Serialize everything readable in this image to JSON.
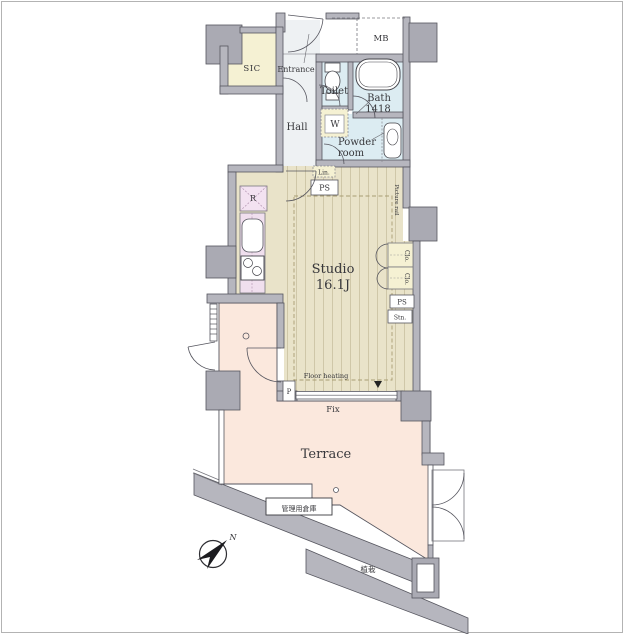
{
  "rooms": {
    "studio": {
      "label": "Studio",
      "size": "16.1J"
    },
    "terrace": {
      "label": "Terrace"
    },
    "hall": {
      "label": "Hall"
    },
    "entrance": {
      "label": "Entrance"
    },
    "toilet": {
      "label": "Toilet"
    },
    "bath": {
      "label": "Bath",
      "size": "1418"
    },
    "powder_room": {
      "line1": "Powder",
      "line2": "room"
    },
    "sic": {
      "label": "SIC"
    },
    "mb": {
      "label": "MB"
    }
  },
  "fixtures": {
    "linen": "Lin.",
    "ps_top": "PS",
    "fridge": "R",
    "washer": "W",
    "closet_upper": "Clo.",
    "closet_lower": "Clo.",
    "ps_right": "PS",
    "station": "Stn.",
    "picture_rail": "Picture rail",
    "floor_heating": "Floor heating",
    "fix_window": "Fix",
    "pipe_p": "P",
    "storage": "管理用倉庫",
    "planting": "植栽",
    "north": "N"
  },
  "colors": {
    "wall": "#b6b6be",
    "pillar": "#aaaab3",
    "wet_area": "#dcecf2",
    "pale_yellow": "#f5f1d3",
    "hall_floor": "#eef1f3",
    "wood_floor": "#e9e3c9",
    "wood_line": "#cfc7a8",
    "kitchen": "#f0dfee",
    "terrace": "#fbe8dd",
    "outline": "#55555e"
  }
}
